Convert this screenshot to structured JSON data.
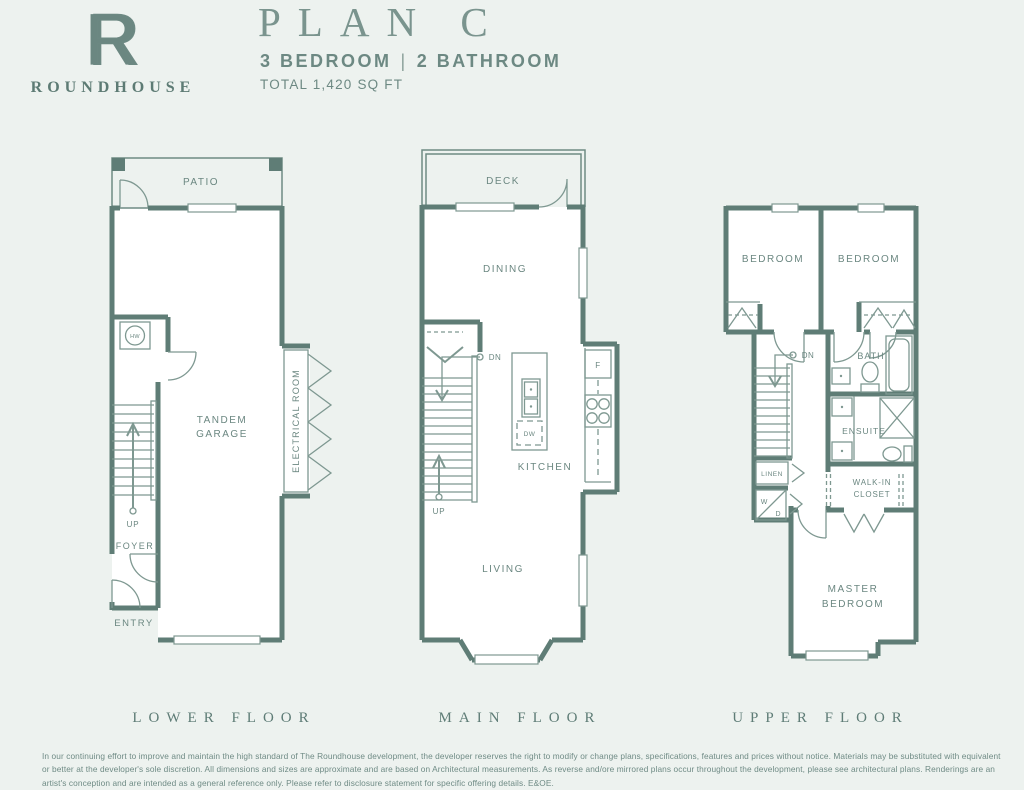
{
  "header": {
    "logo_letter": "R",
    "brand": "ROUNDHOUSE",
    "title": "PLAN C",
    "bedrooms": "3 BEDROOM",
    "divider": "|",
    "bathrooms": "2 BATHROOM",
    "total": "TOTAL 1,420 SQ FT"
  },
  "floors": {
    "lower": {
      "name": "LOWER FLOOR",
      "labels": {
        "patio": "PATIO",
        "hw": "HW",
        "garage1": "TANDEM",
        "garage2": "GARAGE",
        "electrical": "ELECTRICAL ROOM",
        "up": "UP",
        "foyer": "FOYER",
        "entry": "ENTRY"
      }
    },
    "main": {
      "name": "MAIN FLOOR",
      "labels": {
        "deck": "DECK",
        "dining": "DINING",
        "dn": "DN",
        "fridge": "F",
        "dw": "DW",
        "kitchen": "KITCHEN",
        "up": "UP",
        "living": "LIVING"
      }
    },
    "upper": {
      "name": "UPPER FLOOR",
      "labels": {
        "bedroom1": "BEDROOM",
        "bedroom2": "BEDROOM",
        "dn": "DN",
        "bath": "BATH",
        "linen": "LINEN",
        "washer": "W",
        "dryer": "D",
        "ensuite": "ENSUITE",
        "walkin1": "WALK-IN",
        "walkin2": "CLOSET",
        "master1": "MASTER",
        "master2": "BEDROOM"
      }
    }
  },
  "footer": {
    "disclaimer": "In our continuing effort to improve and maintain the high standard of The Roundhouse development, the developer reserves the right to modify or change plans, specifications, features and prices without notice. Materials may be substituted with equivalent or better at the developer's sole discretion. All dimensions and sizes are approximate and are based on Architectural measurements. As reverse and/ore mirrored plans occur throughout the development, please see architectural plans. Renderings are an artist's conception and are intended as a general reference only. Please refer to disclosure statement for specific offering details. E&OE."
  },
  "colors": {
    "background": "#edf2ef",
    "wall": "#5f7d76",
    "thin_line": "#7e9891",
    "text": "#6b8781"
  }
}
